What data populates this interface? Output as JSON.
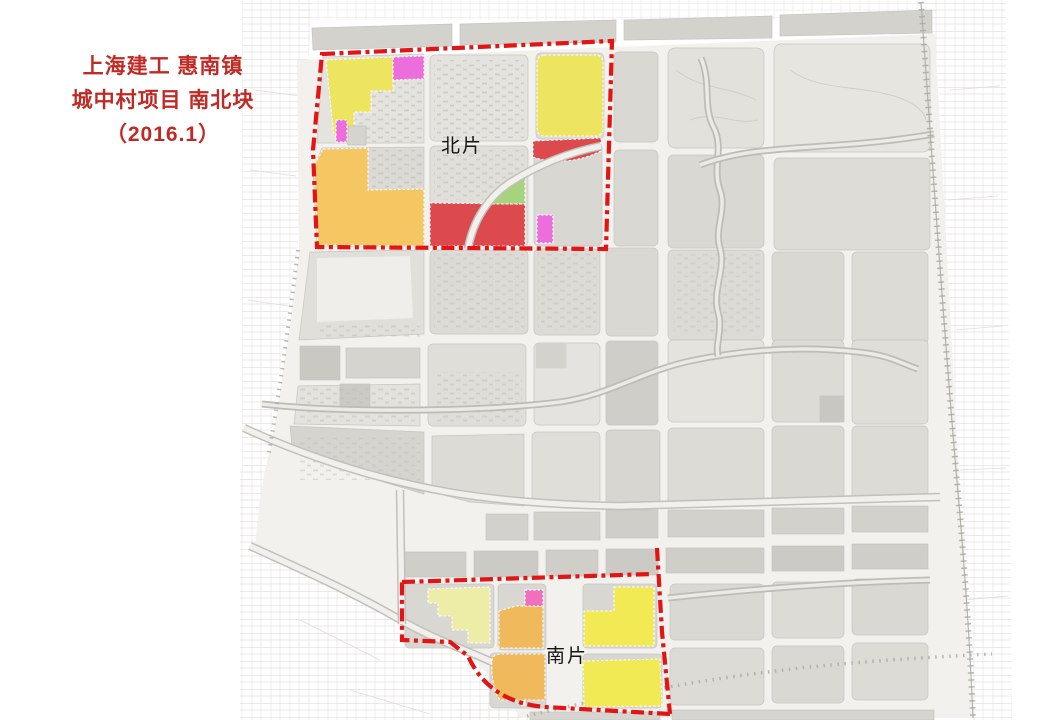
{
  "title": {
    "line1": "上海建工 惠南镇",
    "line2": "城中村项目 南北块",
    "line3": "（2016.1）",
    "color": "#BF2A25"
  },
  "map": {
    "labels": {
      "north_area": "北片",
      "south_area": "南片"
    },
    "colors": {
      "boundary": "#E21414",
      "parcel_yellow": "#EDE45F",
      "parcel_yellow_bright": "#F1EA54",
      "parcel_pale_yellow": "#EDEDA8",
      "parcel_orange": "#F4C763",
      "parcel_orange_deep": "#F0B95C",
      "parcel_red": "#DD4A4E",
      "parcel_magenta": "#EC6EDC",
      "parcel_pink": "#F070BE",
      "parcel_green": "#A8D37D",
      "block_gray": "#DBDAD5",
      "road": "#F2F1ED"
    }
  }
}
